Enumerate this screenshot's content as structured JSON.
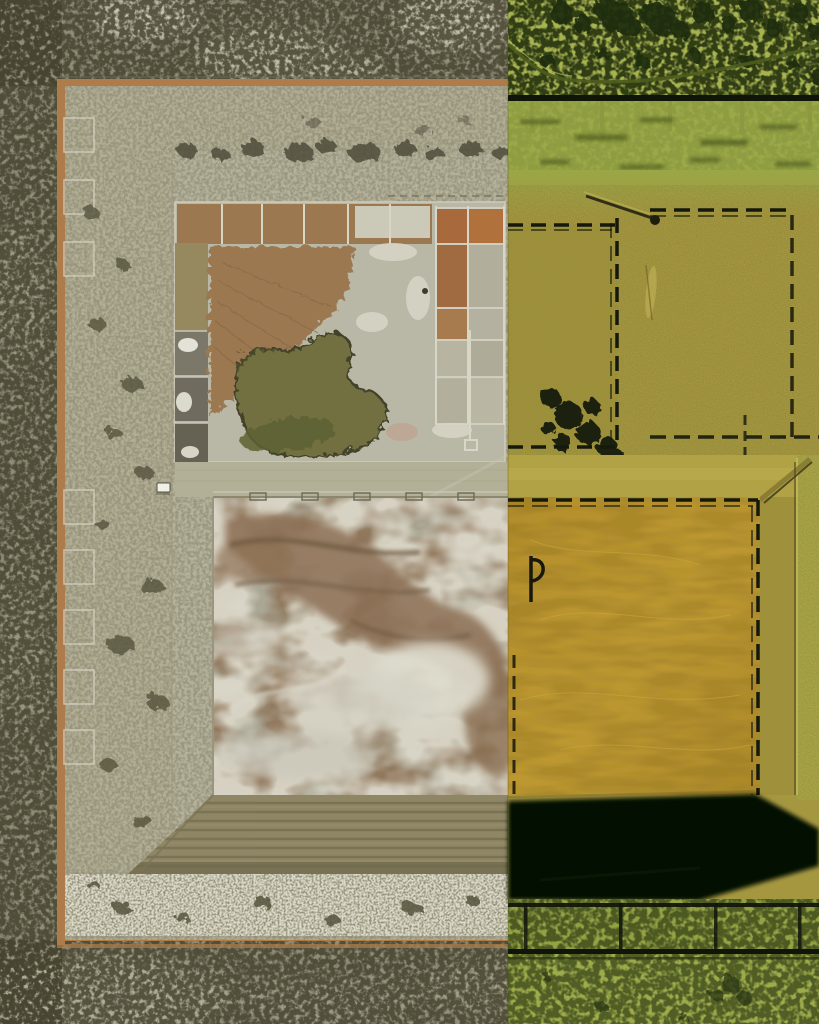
{
  "scene": {
    "description": "Aerial orthophoto of a large square earthen evaporation-pond facility in scrubland; the right portion of the frame is covered by an opaque yellow-green LiDAR hillshade overlay of the same facility",
    "left_panel": "natural-color aerial photograph",
    "right_panel": "LiDAR colored hillshade overlay",
    "overlay_split_x": 508,
    "image_width": 819,
    "image_height": 1024
  },
  "regions": {
    "outer_scrubland": "mottled desert scrub vegetation surrounding facility",
    "dirt_perimeter_road": "orange-brown dirt edge lines around berm",
    "berm_ring": "wide light gray-green embankment crest",
    "upper_pond_cell": "cell with brown dried mud fan, dark olive water body, light evaporite crust and small orange sub-cells",
    "lower_pond_cell": "cell with swirled brown wet mud and white salt crust",
    "terraced_slope": "striped inner slope at bottom of facility",
    "white_vehicle": "small white vehicle parked on interior road",
    "lidar_tree_canopy": "dark tree blobs on green hillshade",
    "lidar_berm_lines": "black dashed ladder outlines of berms",
    "lidar_mustard_cell": "smooth ochre pond floor in hillshade",
    "lidar_shadow": "solid black hillshade shadow cast by south berm"
  },
  "palette": {
    "scrub": "#8f8c77",
    "scrubDark": "#45432f",
    "dirt": "#ad7c4a",
    "berm": "#b1ae95",
    "crust": "#b9b7a5",
    "pondBrown": "#9b7850",
    "water": "#72703f",
    "salt": "#dedbcd",
    "cellGray": "#aaa795",
    "slope": "#8e8664",
    "orangeCell": "#a86a3c",
    "vehicle": "#f2f1e8",
    "lgreen": "#a7b350",
    "lgreen2": "#9dab4b",
    "olive": "#a49740",
    "mustard": "#b9952f",
    "tree": "#1f2c10",
    "lblack": "#10150a",
    "shadow": "#060903"
  }
}
